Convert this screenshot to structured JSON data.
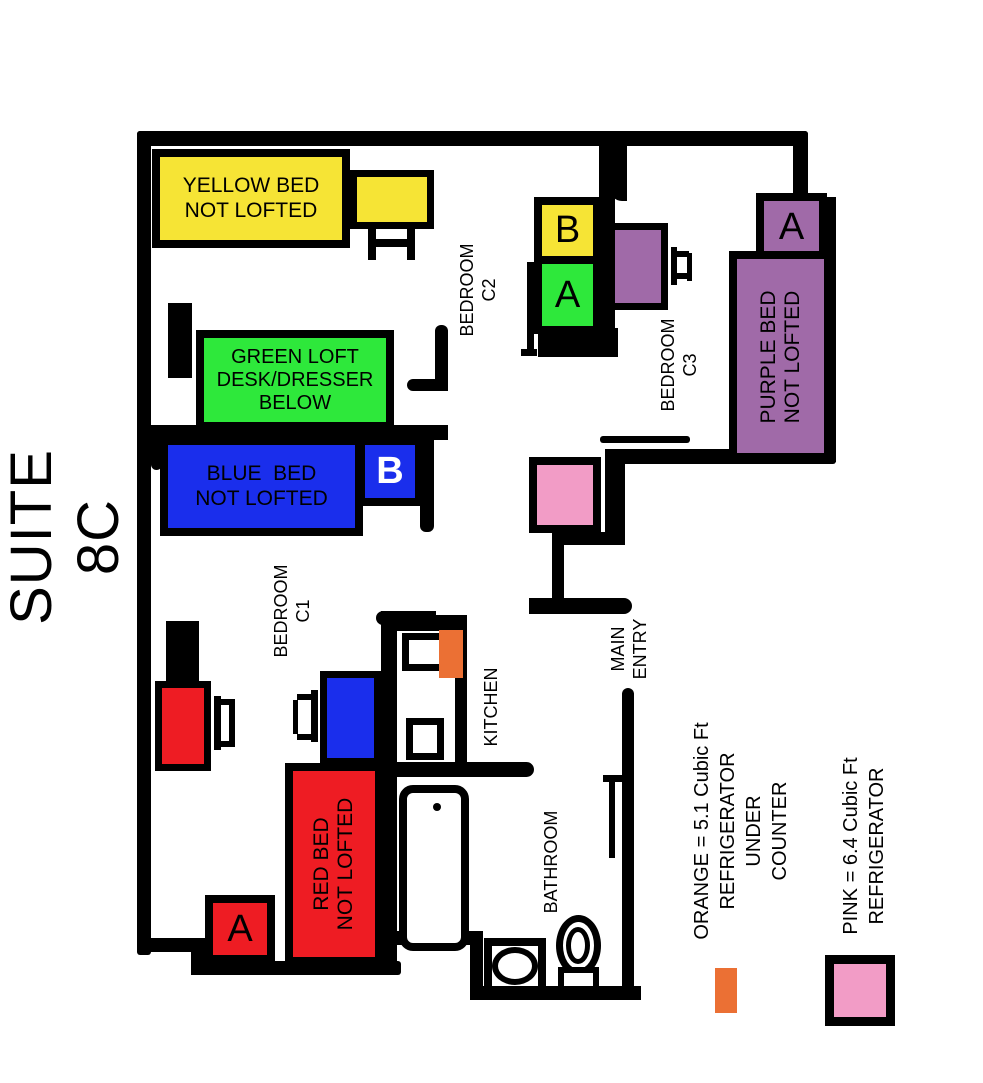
{
  "title": "SUITE 8C",
  "colors": {
    "yellow": "#F6E435",
    "green": "#2EE83B",
    "blue": "#1A2EEC",
    "red": "#EE1C23",
    "purple": "#A06AA8",
    "pink": "#F29CC6",
    "orange": "#EB7034"
  },
  "rooms": {
    "c1": {
      "label": "BEDROOM\nC1"
    },
    "c2": {
      "label": "BEDROOM\nC2"
    },
    "c3": {
      "label": "BEDROOM\nC3"
    },
    "kitchen": {
      "label": "KITCHEN"
    },
    "bathroom": {
      "label": "BATHROOM"
    },
    "main_entry": {
      "label": "MAIN\nENTRY"
    }
  },
  "furniture": {
    "yellow_bed": {
      "label": "YELLOW BED\nNOT LOFTED"
    },
    "green_loft": {
      "label": "GREEN LOFT\nDESK/DRESSER\nBELOW"
    },
    "blue_bed": {
      "label": "BLUE  BED\nNOT LOFTED"
    },
    "red_bed": {
      "label": "RED BED\nNOT LOFTED"
    },
    "purple_bed": {
      "label": "PURPLE BED\nNOT LOFTED"
    },
    "tags": {
      "c2_closet_b": "B",
      "c2_closet_a": "A",
      "c1_closet_b": "B",
      "c1_closet_a": "A",
      "c3_closet_a": "A"
    }
  },
  "legend": {
    "orange": {
      "label": "ORANGE = 5.1 Cubic Ft\nREFRIGERATOR UNDER\nCOUNTER"
    },
    "pink": {
      "label": "PINK = 6.4 Cubic Ft\nREFRIGERATOR"
    }
  }
}
